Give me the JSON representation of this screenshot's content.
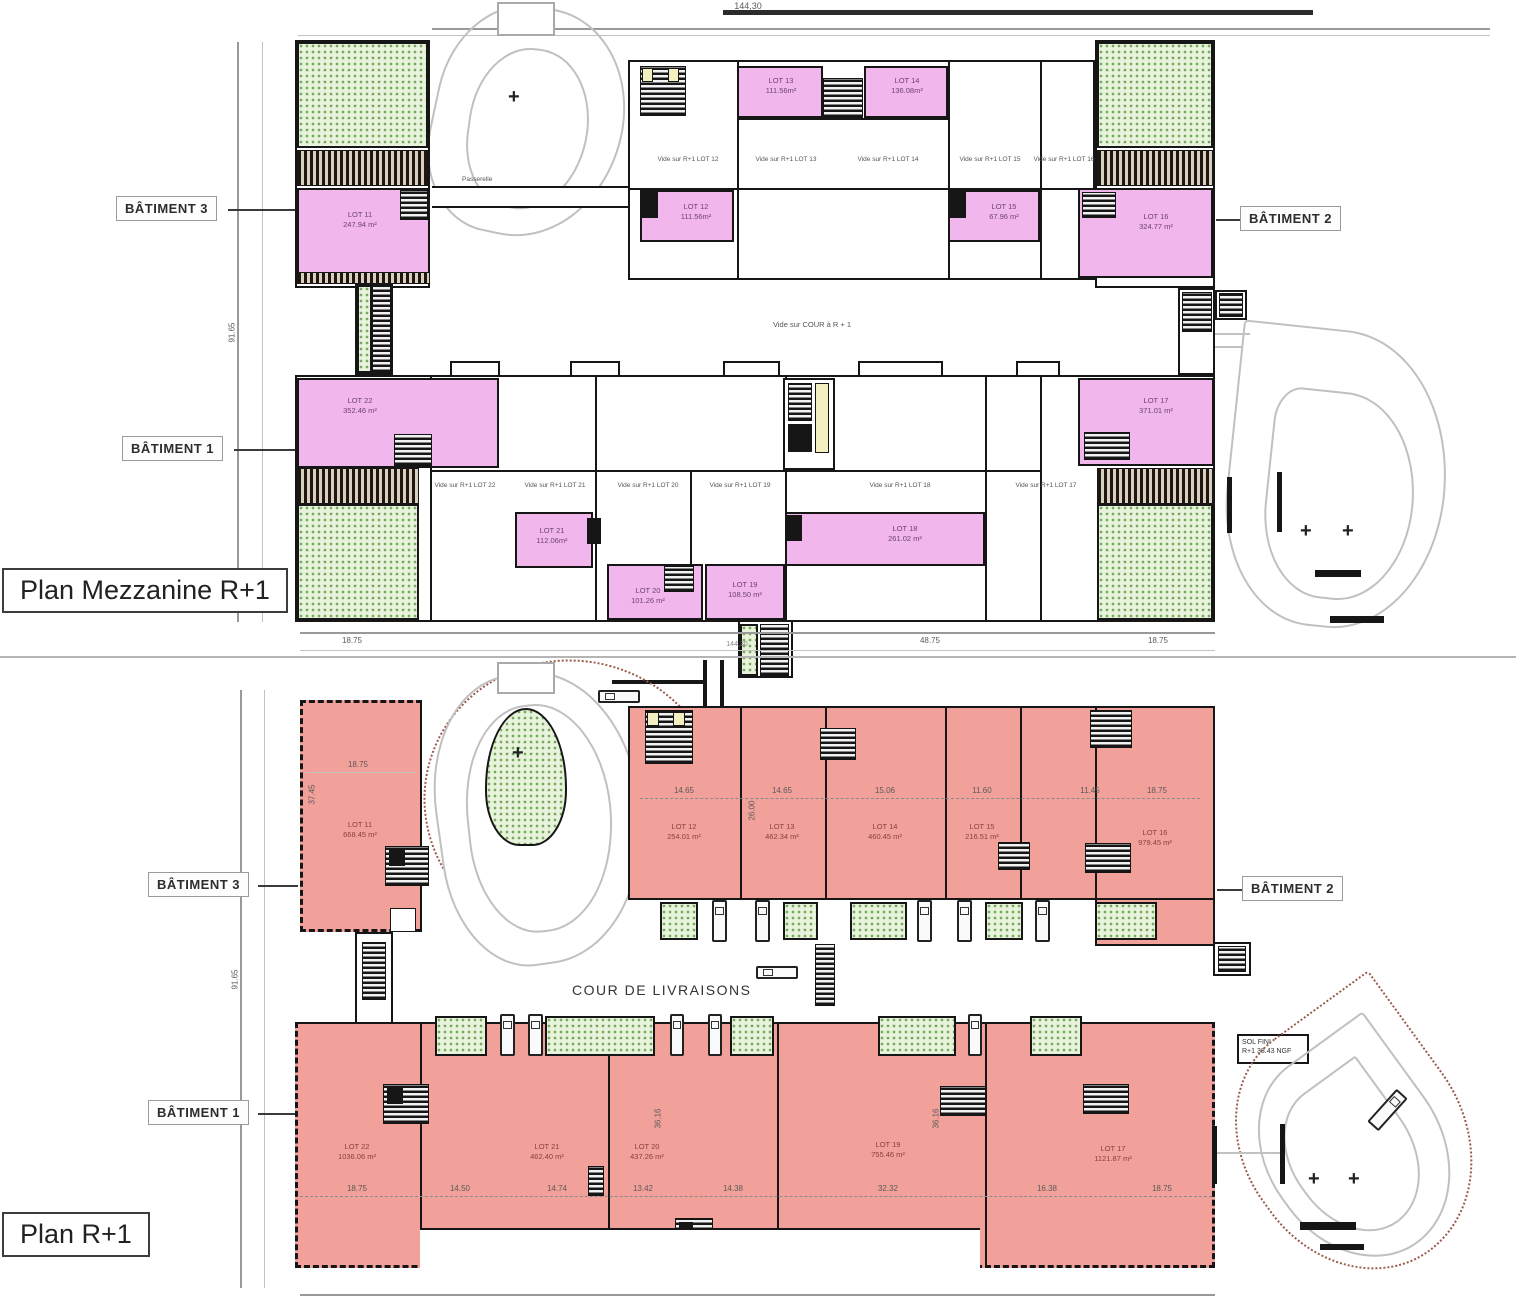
{
  "colors": {
    "pink": "#f1b6ec",
    "salmon": "#f1a19a",
    "green_fill": "#e7f3da",
    "green_dot": "#79a861",
    "wall": "#161616"
  },
  "mezzanine": {
    "title": "Plan Mezzanine R+1",
    "dim_total": "144,30",
    "dim_height": "91.65",
    "batiment1": "BÂTIMENT 1",
    "batiment2": "BÂTIMENT 2",
    "batiment3": "BÂTIMENT 3",
    "courtyard_label": "Vide sur COUR à R + 1",
    "passerelle_label": "Passerelle",
    "lots": {
      "l11": {
        "name": "LOT 11",
        "area": "247.94 m²"
      },
      "l12": {
        "name": "LOT 12",
        "area": "111.56m²"
      },
      "l13": {
        "name": "LOT 13",
        "area": "111.56m²"
      },
      "l14": {
        "name": "LOT 14",
        "area": "136.08m²"
      },
      "l15": {
        "name": "LOT 15",
        "area": "67.96 m²"
      },
      "l16": {
        "name": "LOT 16",
        "area": "324.77 m²"
      },
      "l17": {
        "name": "LOT 17",
        "area": "371.01 m²"
      },
      "l18": {
        "name": "LOT 18",
        "area": "261.02 m²"
      },
      "l19": {
        "name": "LOT 19",
        "area": "108.50 m²"
      },
      "l20": {
        "name": "LOT 20",
        "area": "101.26 m²"
      },
      "l21": {
        "name": "LOT 21",
        "area": "112.06m²"
      },
      "l22": {
        "name": "LOT 22",
        "area": "352.46 m²"
      }
    },
    "vides": {
      "v12": "Vide sur R+1 LOT 12",
      "v13": "Vide sur R+1 LOT 13",
      "v14": "Vide sur R+1 LOT 14",
      "v15": "Vide sur R+1 LOT 15",
      "v16": "Vide sur R+1 LOT 16",
      "v17": "Vide sur R+1 LOT 17",
      "v18": "Vide sur R+1 LOT 18",
      "v19": "Vide sur R+1 LOT 19",
      "v20": "Vide sur R+1 LOT 20",
      "v21": "Vide sur R+1 LOT 21",
      "v22": "Vide sur R+1 LOT 22"
    },
    "dims_bottom": {
      "d1": "18.75",
      "d2": "48.75",
      "d3": "18.75",
      "total": "144,30"
    }
  },
  "r1": {
    "title": "Plan R+1",
    "dim_height": "91.65",
    "batiment1": "BÂTIMENT 1",
    "batiment2": "BÂTIMENT 2",
    "batiment3": "BÂTIMENT 3",
    "cour_label": "COUR DE LIVRAISONS",
    "sol_fini": {
      "line1": "SOL FINI",
      "line2": "R+1 38.43 NGF"
    },
    "lots": {
      "l11": {
        "name": "LOT 11",
        "area": "668.45 m²"
      },
      "l12": {
        "name": "LOT 12",
        "area": "254.01 m²"
      },
      "l13": {
        "name": "LOT 13",
        "area": "462.34 m²"
      },
      "l14": {
        "name": "LOT 14",
        "area": "460.45 m²"
      },
      "l15": {
        "name": "LOT 15",
        "area": "216.51 m²"
      },
      "l16": {
        "name": "LOT 16",
        "area": "979.45 m²"
      },
      "l17": {
        "name": "LOT 17",
        "area": "1121.87 m²"
      },
      "l19": {
        "name": "LOT 19",
        "area": "755.46 m²"
      },
      "l20": {
        "name": "LOT 20",
        "area": "437.26 m²"
      },
      "l21": {
        "name": "LOT 21",
        "area": "462.40 m²"
      },
      "l22": {
        "name": "LOT 22",
        "area": "1036.06 m²"
      }
    },
    "dims_upper": {
      "lot11_w": "18.75",
      "lot11_h": "37.45",
      "d12": "14.65",
      "d13": "14.65",
      "d14": "15.06",
      "d15": "11.60",
      "d16a": "11.45",
      "d16b": "18.75",
      "depth": "26.00"
    },
    "dims_lower": {
      "d22a": "18.75",
      "d22b": "14.50",
      "d21": "14.74",
      "d20a": "13.42",
      "d20b": "14.38",
      "d19": "32.32",
      "d17a": "16.38",
      "d17b": "18.75",
      "v1": "36.16",
      "v2": "36.16"
    }
  }
}
